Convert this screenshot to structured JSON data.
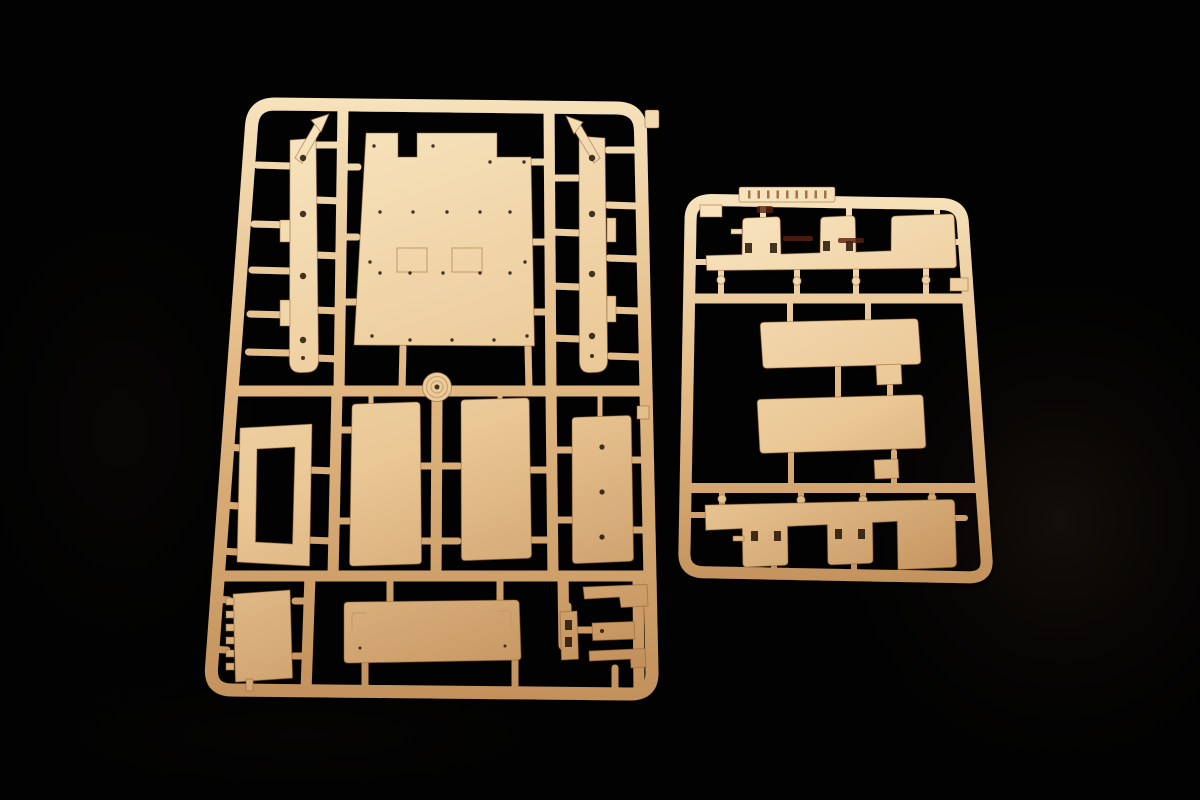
{
  "scene": {
    "description": "Studio photograph of two tan injection-molded plastic model kit sprues (part runners) lying on a black background",
    "palette": {
      "background": "#020202",
      "backdrop_sheen": "#1b130c",
      "backdrop_sheen_soft": "#0e0a07",
      "plastic_light": "#f7e3bd",
      "plastic_mid": "#eac795",
      "plastic_base": "#e3b983",
      "plastic_dark": "#c2905a",
      "plastic_edge": "#8a5c2f",
      "hole_dark": "#241507",
      "detail_line": "#c09764",
      "mark_dark": "#57200f"
    },
    "objects": {
      "large_sprue": {
        "label": "large parts runner",
        "parts": [
          "left chassis rail",
          "right chassis rail",
          "hull floor plate with rivet holes and two hatch outlines",
          "round hub",
          "open frame panel",
          "tall side panel A",
          "tall side panel B",
          "drilled side panel",
          "ribbed plate",
          "long lower panel with bracket outlines",
          "small bracket set"
        ]
      },
      "small_sprue": {
        "label": "small parts runner",
        "parts": [
          "molded id tab",
          "upper seat-back strip",
          "upper long panel",
          "lower long panel",
          "lower seat-back strip"
        ]
      }
    }
  }
}
